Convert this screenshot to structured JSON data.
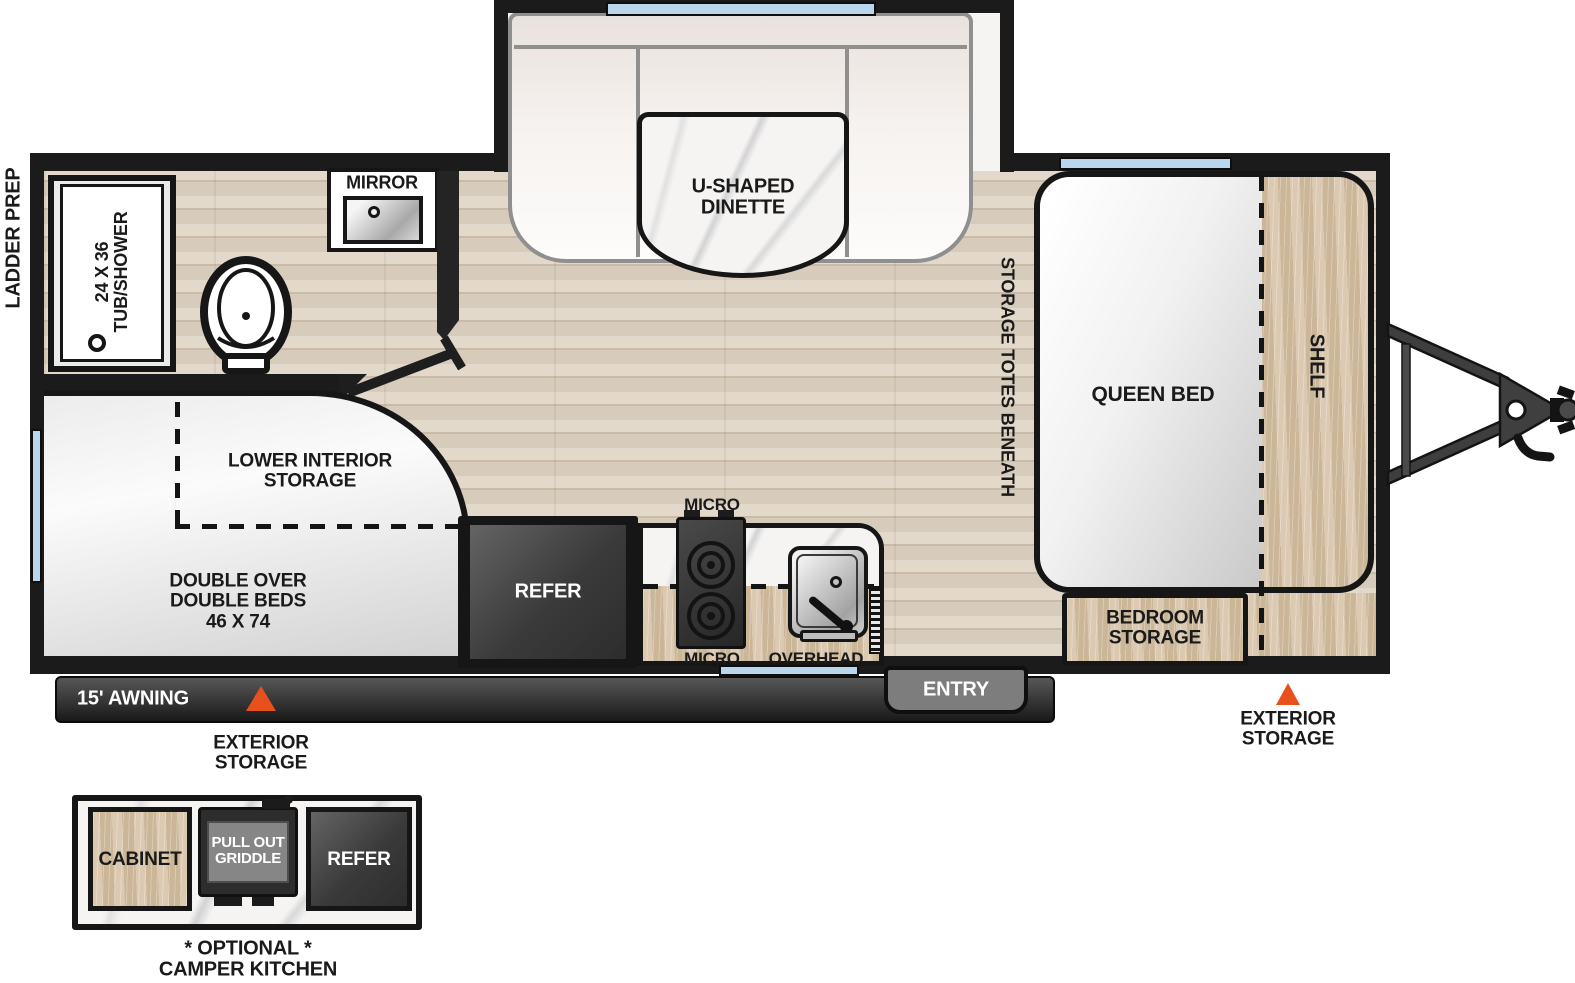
{
  "title": "Travel trailer floor plan",
  "colors": {
    "wall": "#1b1b1b",
    "window_blue": "#b9d6ec",
    "accent_orange": "#e8501e",
    "wood_floor": "#dcd2c4",
    "cabinet_wood": "#d4c1a8",
    "entry_gray": "#7d7d7d"
  },
  "exterior": {
    "ladder_prep": "LADDER PREP",
    "awning": "15' AWNING",
    "entry": "ENTRY",
    "exterior_storage_left": "EXTERIOR\nSTORAGE",
    "exterior_storage_right": "EXTERIOR\nSTORAGE"
  },
  "bathroom": {
    "tub": "24 X 36\nTUB/SHOWER",
    "mirror": "MIRROR"
  },
  "dinette": {
    "label": "U-SHAPED\nDINETTE"
  },
  "bedroom": {
    "storage_totes": "STORAGE TOTES BENEATH",
    "queen_bed": "QUEEN BED",
    "shelf": "SHELF",
    "bedroom_storage": "BEDROOM\nSTORAGE"
  },
  "bunk": {
    "lower_interior_storage": "LOWER INTERIOR\nSTORAGE",
    "double_beds": "DOUBLE OVER\nDOUBLE BEDS\n46 X 74"
  },
  "kitchen": {
    "refer": "REFER",
    "micro_top": "MICRO",
    "micro_bottom": "MICRO",
    "overhead": "OVERHEAD"
  },
  "camper_kitchen": {
    "cabinet": "CABINET",
    "griddle": "PULL OUT\nGRIDDLE",
    "refer": "REFER",
    "caption": "* OPTIONAL *\nCAMPER KITCHEN"
  }
}
